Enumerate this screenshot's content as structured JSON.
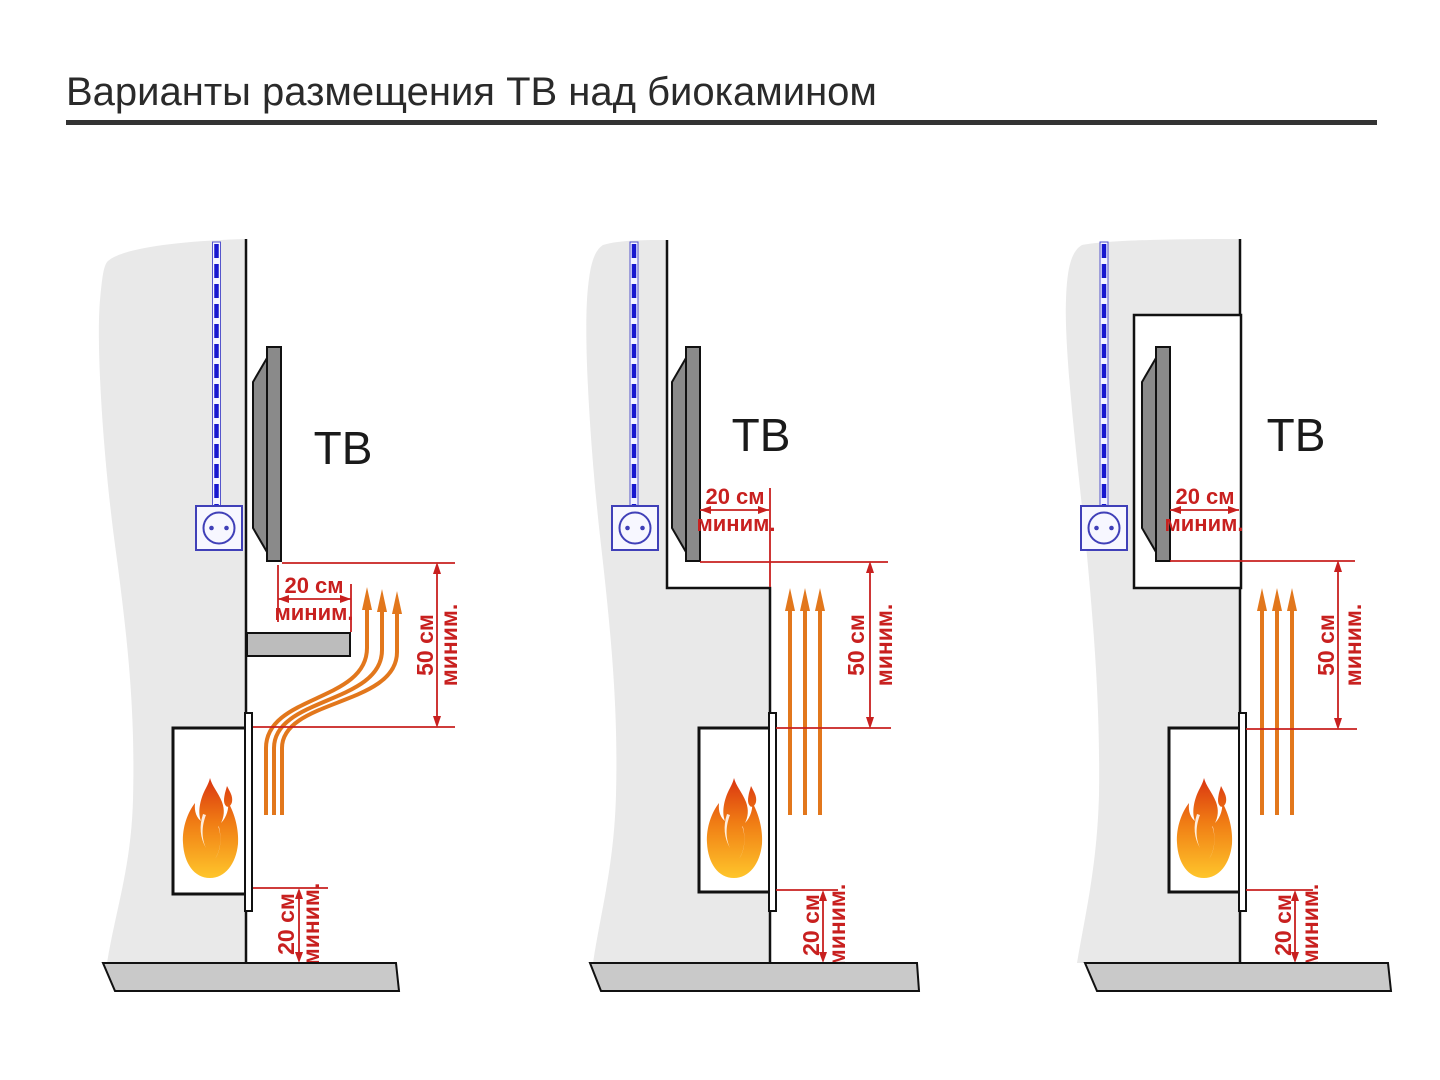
{
  "title": "Варианты размещения ТВ над биокамином",
  "labels": {
    "tv": "ТВ",
    "cm20": "20 см",
    "cm50": "50 см",
    "minim": "миним."
  },
  "colors": {
    "dimension_red": "#c8201f",
    "heat_orange": "#e2771c",
    "cable_blue": "#1717cf",
    "wall_gray": "#e9e9e9",
    "floor_gray": "#c9c9c9",
    "tv_gray": "#8a8a8a"
  },
  "diagrams": [
    {
      "tv_label": "ТВ",
      "side_gap": "20 см миним.",
      "above_gap": "50 см миним.",
      "floor_gap": "20 см миним."
    },
    {
      "tv_label": "ТВ",
      "side_gap": "20 см миним.",
      "above_gap": "50 см миним.",
      "floor_gap": "20 см миним."
    },
    {
      "tv_label": "ТВ",
      "side_gap": "20 см миним.",
      "above_gap": "50 см миним.",
      "floor_gap": "20 см миним."
    }
  ]
}
